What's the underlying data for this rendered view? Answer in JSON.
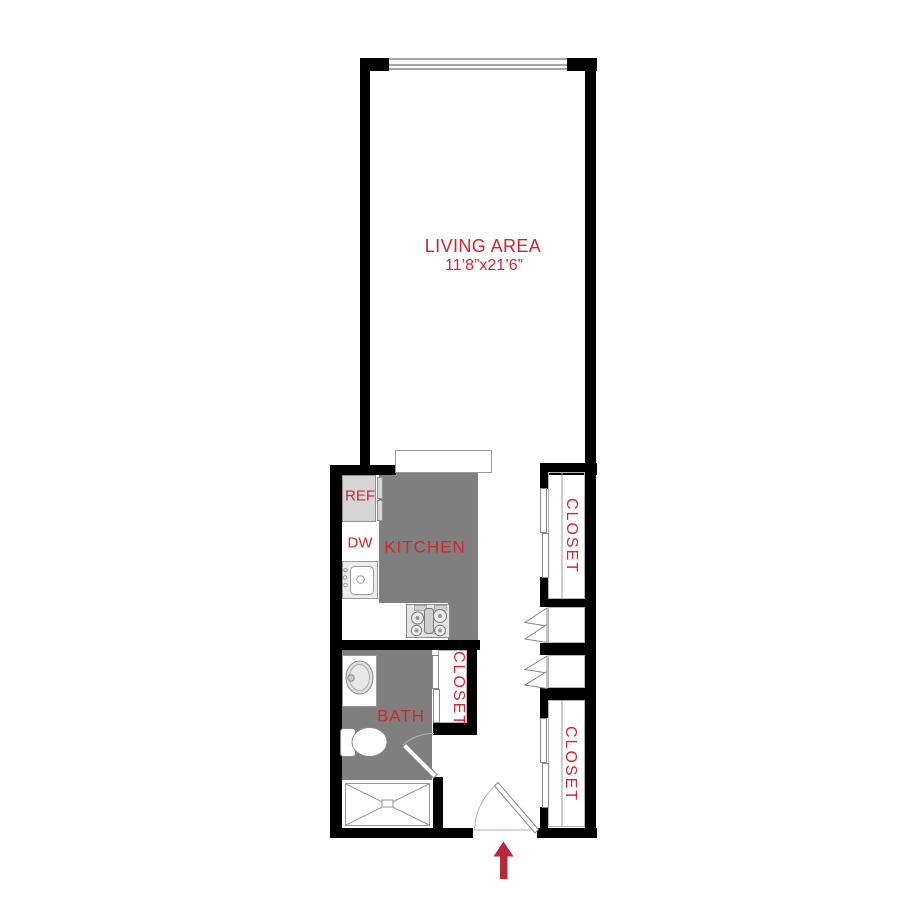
{
  "plan": {
    "type": "floor-plan",
    "rooms": [
      {
        "id": "living",
        "label": "LIVING AREA",
        "dimensions": "11’8”x21’6”"
      },
      {
        "id": "kitchen",
        "label": "KITCHEN"
      },
      {
        "id": "bath",
        "label": "BATH"
      },
      {
        "id": "closet_hall",
        "label": "CLOSET"
      },
      {
        "id": "closet_upper_right",
        "label": "CLOSET"
      },
      {
        "id": "closet_lower_right",
        "label": "CLOSET"
      }
    ],
    "appliances": [
      {
        "id": "refrigerator",
        "label": "REF"
      },
      {
        "id": "dishwasher",
        "label": "DW"
      }
    ],
    "fixtures": [
      "window",
      "kitchen-sink",
      "stove",
      "counter-peninsula",
      "bath-sink",
      "toilet",
      "shower",
      "bath-swing-door",
      "entry-swing-door",
      "sliding-closet-doors",
      "bifold-doors"
    ],
    "entry_arrow": {
      "direction": "up"
    },
    "colors": {
      "wall": "#000000",
      "room_fill": "#7f7f7f",
      "appliance_fill": "#d5d5d5",
      "label_red": "#d2262c",
      "arrow_red": "#b5293a",
      "line_gray": "#999999"
    }
  }
}
